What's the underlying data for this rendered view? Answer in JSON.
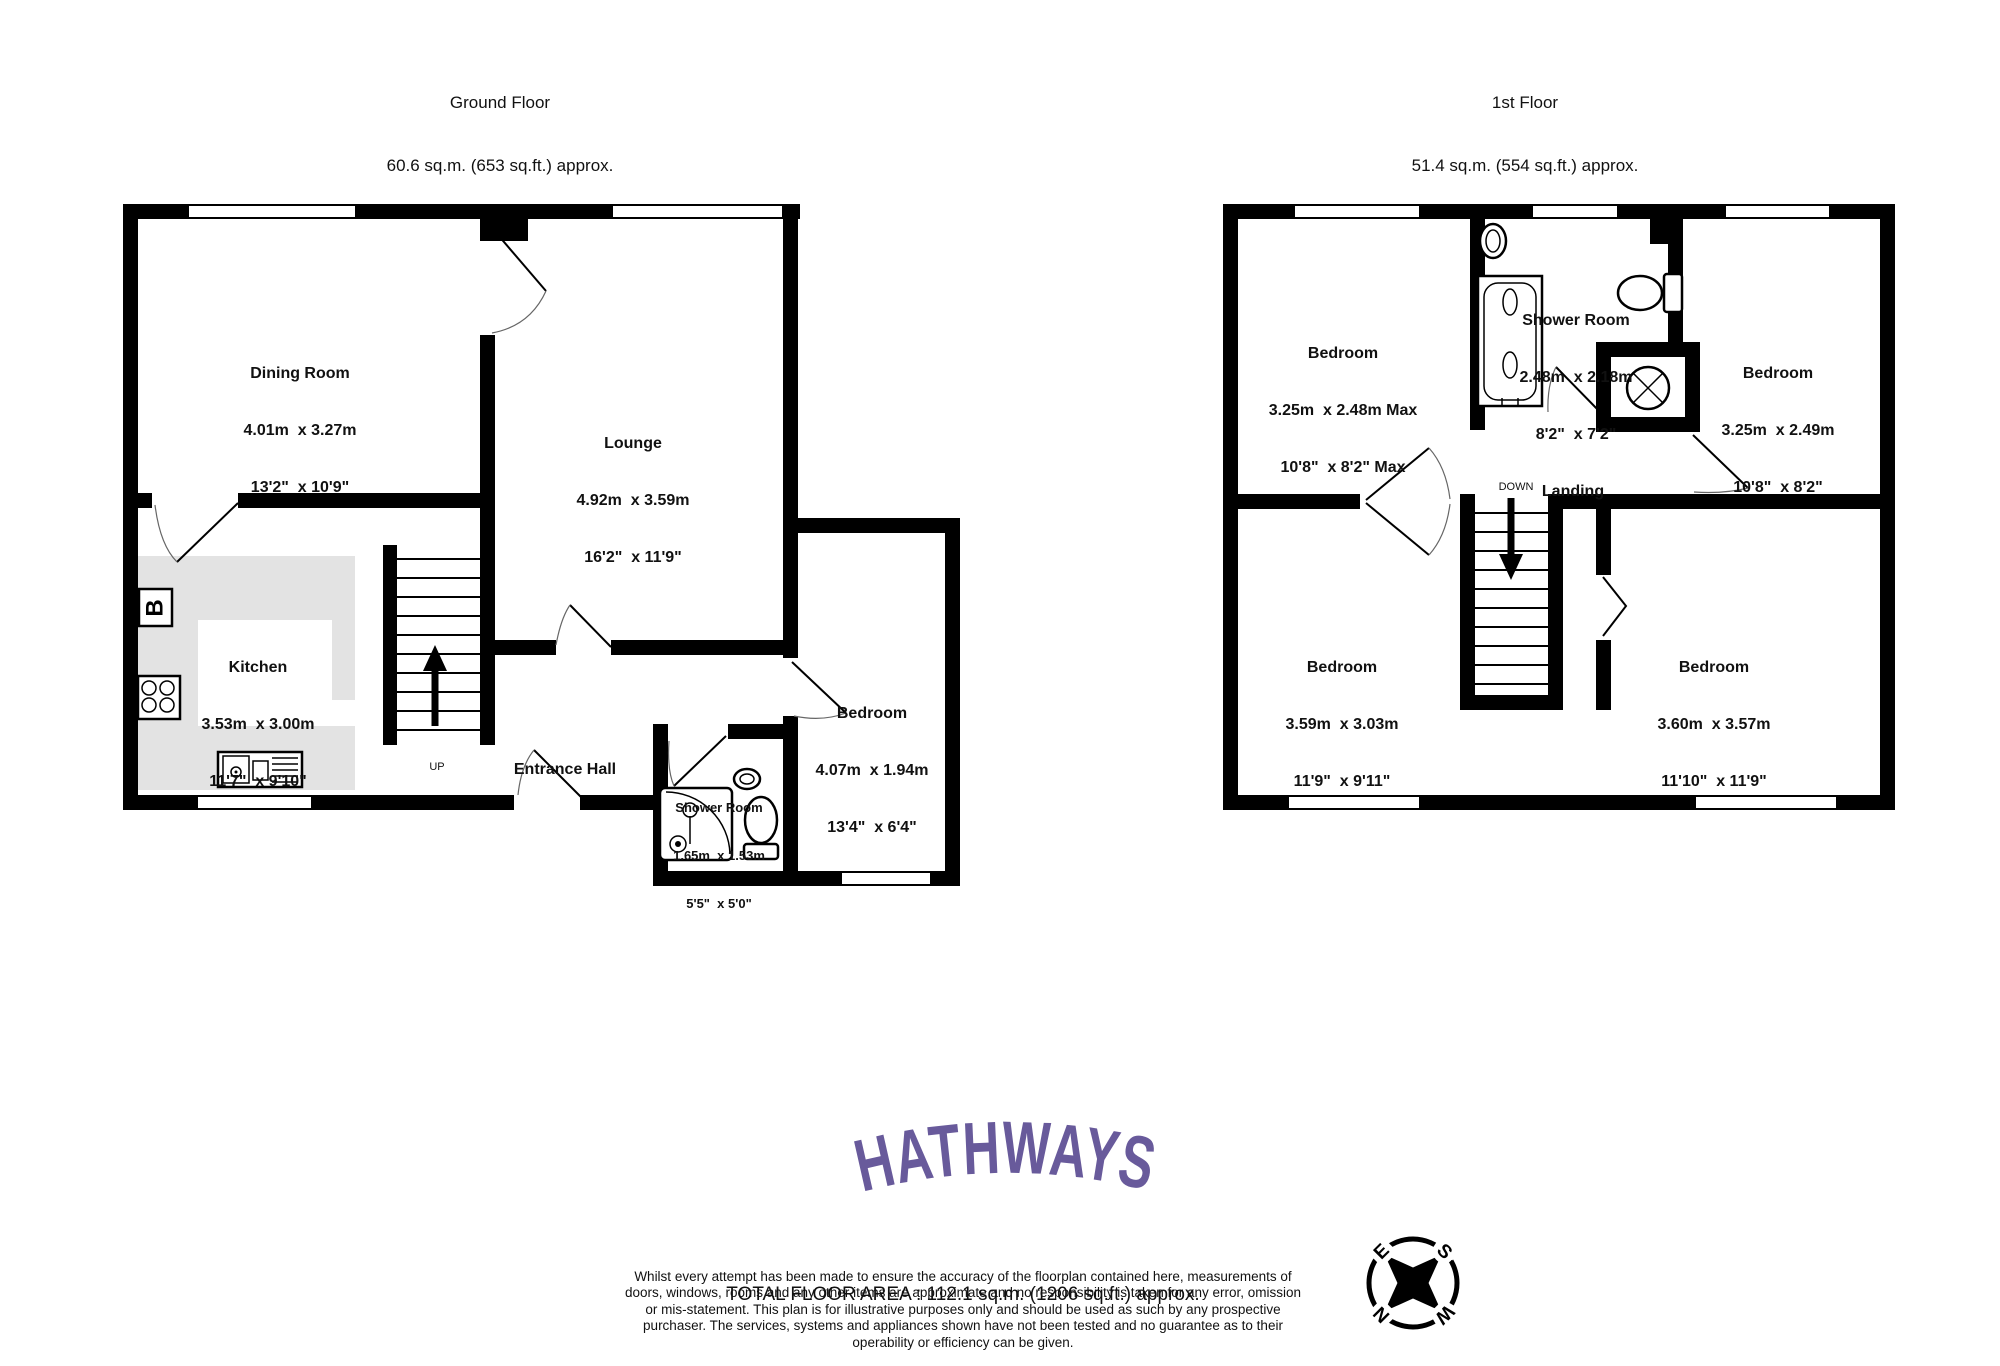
{
  "ground_floor": {
    "title": "Ground Floor",
    "subtitle": "60.6 sq.m. (653 sq.ft.) approx.",
    "stairs_label": "UP",
    "boiler_label": "B",
    "rooms": [
      {
        "name": "Dining Room",
        "metric": "4.01m  x 3.27m",
        "imperial": "13'2\"  x 10'9\""
      },
      {
        "name": "Lounge",
        "metric": "4.92m  x 3.59m",
        "imperial": "16'2\"  x 11'9\""
      },
      {
        "name": "Kitchen",
        "metric": "3.53m  x 3.00m",
        "imperial": "11'7\"  x 9'10\""
      },
      {
        "name": "Entrance Hall",
        "metric": "",
        "imperial": ""
      },
      {
        "name": "Bedroom",
        "metric": "4.07m  x 1.94m",
        "imperial": "13'4\"  x 6'4\""
      },
      {
        "name": "Shower Room",
        "metric": "1.65m  x 1.53m",
        "imperial": "5'5\"  x 5'0\""
      }
    ]
  },
  "first_floor": {
    "title": "1st Floor",
    "subtitle": "51.4 sq.m. (554 sq.ft.) approx.",
    "stairs_label": "DOWN",
    "rooms": [
      {
        "name": "Bedroom",
        "metric": "3.25m  x 2.48m Max",
        "imperial": "10'8\"  x 8'2\" Max"
      },
      {
        "name": "Shower Room",
        "metric": "2.48m  x 2.18m",
        "imperial": "8'2\"  x 7'2\""
      },
      {
        "name": "Bedroom",
        "metric": "3.25m  x 2.49m",
        "imperial": "10'8\"  x 8'2\""
      },
      {
        "name": "Landing",
        "metric": "",
        "imperial": ""
      },
      {
        "name": "Bedroom",
        "metric": "3.59m  x 3.03m",
        "imperial": "11'9\"  x 9'11\""
      },
      {
        "name": "Bedroom",
        "metric": "3.60m  x 3.57m",
        "imperial": "11'10\"  x 11'9\""
      }
    ]
  },
  "footer": {
    "logo": "HATHWAYS",
    "total_area": "TOTAL FLOOR AREA : 112.1 sq.m. (1206 sq.ft.) approx.",
    "disclaimer": "Whilst every attempt has been made to ensure the accuracy of the floorplan contained here, measurements of doors, windows, rooms and any other items are approximate and no responsibility is taken for any error, omission or mis-statement. This plan is for illustrative purposes only and should be used as such by any prospective purchaser. The services, systems and appliances shown have not been tested and no guarantee as to their operability or efficiency can be given.",
    "credit": "Made with Metropix ©2026"
  },
  "compass": {
    "n": "N",
    "e": "E",
    "s": "S",
    "w": "W"
  },
  "colors": {
    "wall": "#000000",
    "counter": "#e3e3e3",
    "logo_purple": "#685a9b"
  }
}
